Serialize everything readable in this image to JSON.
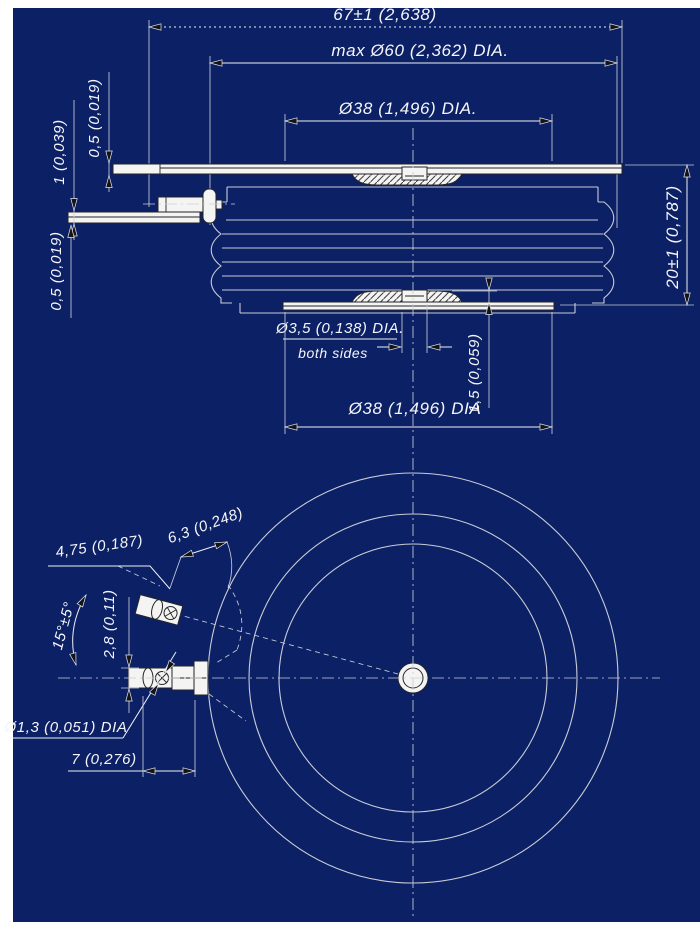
{
  "colors": {
    "background": "#0c2066",
    "line": "#c9cdd6",
    "bright": "#eef0f4",
    "part-fill": "#f4f4f2",
    "part-stroke": "#23252a",
    "text": "#f5f6f8",
    "hatch-line": "#3a3c40"
  },
  "side_view": {
    "dim_overall_width": "67±1 (2,638)",
    "dim_max_diameter": "max Ø60 (2,362) DIA.",
    "dim_pole_diameter_top": "Ø38 (1,496) DIA.",
    "dim_strip_thickness_top": "0,5 (0,019)",
    "dim_gate_lead_thickness": "1 (0,039)",
    "dim_strip_thickness_bottom": "0,5 (0,019)",
    "dim_height": "20±1 (0,787)",
    "dim_gate_hole_diameter": "Ø3,5 (0,138) DIA.",
    "dim_gate_hole_note": "both sides",
    "dim_pole_height": "1,5 (0,059)",
    "dim_pole_diameter_bottom": "Ø38 (1,496) DIA"
  },
  "bottom_view": {
    "dim_terminal_across_flats": "4,75 (0,187)",
    "dim_terminal_length": "6,3 (0,248)",
    "dim_bend_angle": "15°±5°",
    "dim_lead_width": "2,8 (0,11)",
    "dim_wire_hole_diameter": "Ø1,3 (0,051) DIA",
    "dim_terminal_offset": "7 (0,276)"
  }
}
